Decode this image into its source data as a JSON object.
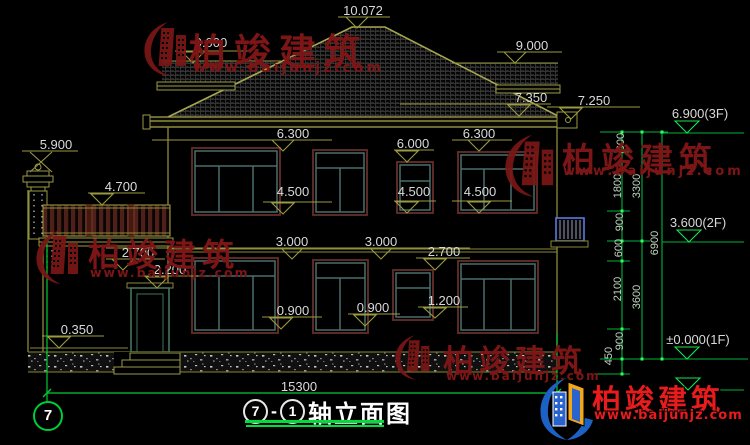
{
  "title": {
    "axis_a": "7",
    "sep": "-",
    "axis_b": "1",
    "name": "轴立面图"
  },
  "axis_bubble_label": "7",
  "watermark": {
    "company": "柏竣建筑",
    "website": "www.baijunjz.com"
  },
  "colors": {
    "background": "#000000",
    "line_olive": "#8a8a3a",
    "dim_green": "#00c040",
    "dim_text": "#d9d9d9",
    "window_frame_teal": "#4b6e6e",
    "window_border_maroon": "#5c2a24",
    "watermark_red": "#7c1616",
    "logo_red": "#e81c1c",
    "title_green": "#00dd3c"
  },
  "labels": [
    {
      "t": "10.072",
      "x": 363,
      "y": 3
    },
    {
      "t": "9.000",
      "x": 211,
      "y": 35
    },
    {
      "t": "9.000",
      "x": 532,
      "y": 38
    },
    {
      "t": "7.350",
      "x": 531,
      "y": 90
    },
    {
      "t": "7.250",
      "x": 594,
      "y": 93
    },
    {
      "t": "6.900(3F)",
      "x": 700,
      "y": 106
    },
    {
      "t": "5.900",
      "x": 56,
      "y": 137
    },
    {
      "t": "4.700",
      "x": 121,
      "y": 179
    },
    {
      "t": "6.300",
      "x": 293,
      "y": 126
    },
    {
      "t": "6.300",
      "x": 479,
      "y": 126
    },
    {
      "t": "6.000",
      "x": 413,
      "y": 136
    },
    {
      "t": "4.500",
      "x": 293,
      "y": 184
    },
    {
      "t": "4.500",
      "x": 414,
      "y": 184
    },
    {
      "t": "4.500",
      "x": 480,
      "y": 184
    },
    {
      "t": "3.600(2F)",
      "x": 698,
      "y": 215
    },
    {
      "t": "3.000",
      "x": 292,
      "y": 234
    },
    {
      "t": "3.000",
      "x": 381,
      "y": 234
    },
    {
      "t": "2.700",
      "x": 138,
      "y": 245
    },
    {
      "t": "2.700",
      "x": 444,
      "y": 244
    },
    {
      "t": "2.200",
      "x": 170,
      "y": 262
    },
    {
      "t": "1.200",
      "x": 444,
      "y": 293
    },
    {
      "t": "0.900",
      "x": 293,
      "y": 303
    },
    {
      "t": "0.900",
      "x": 373,
      "y": 300
    },
    {
      "t": "0.350",
      "x": 77,
      "y": 322
    },
    {
      "t": "±0.000(1F)",
      "x": 698,
      "y": 332
    },
    {
      "t": "15300",
      "x": 299,
      "y": 379
    },
    {
      "t": "600",
      "x": 621,
      "y": 144,
      "cls": "rot"
    },
    {
      "t": "1800",
      "x": 618,
      "y": 188,
      "cls": "rot"
    },
    {
      "t": "3300",
      "x": 637,
      "y": 188,
      "cls": "rot"
    },
    {
      "t": "900",
      "x": 620,
      "y": 224,
      "cls": "rot"
    },
    {
      "t": "600",
      "x": 619,
      "y": 250,
      "cls": "rot"
    },
    {
      "t": "6900",
      "x": 655,
      "y": 245,
      "cls": "rot"
    },
    {
      "t": "2100",
      "x": 618,
      "y": 291,
      "cls": "rot"
    },
    {
      "t": "3600",
      "x": 637,
      "y": 299,
      "cls": "rot"
    },
    {
      "t": "900",
      "x": 620,
      "y": 343,
      "cls": "rot"
    },
    {
      "t": "450",
      "x": 609,
      "y": 358,
      "cls": "rot"
    }
  ]
}
